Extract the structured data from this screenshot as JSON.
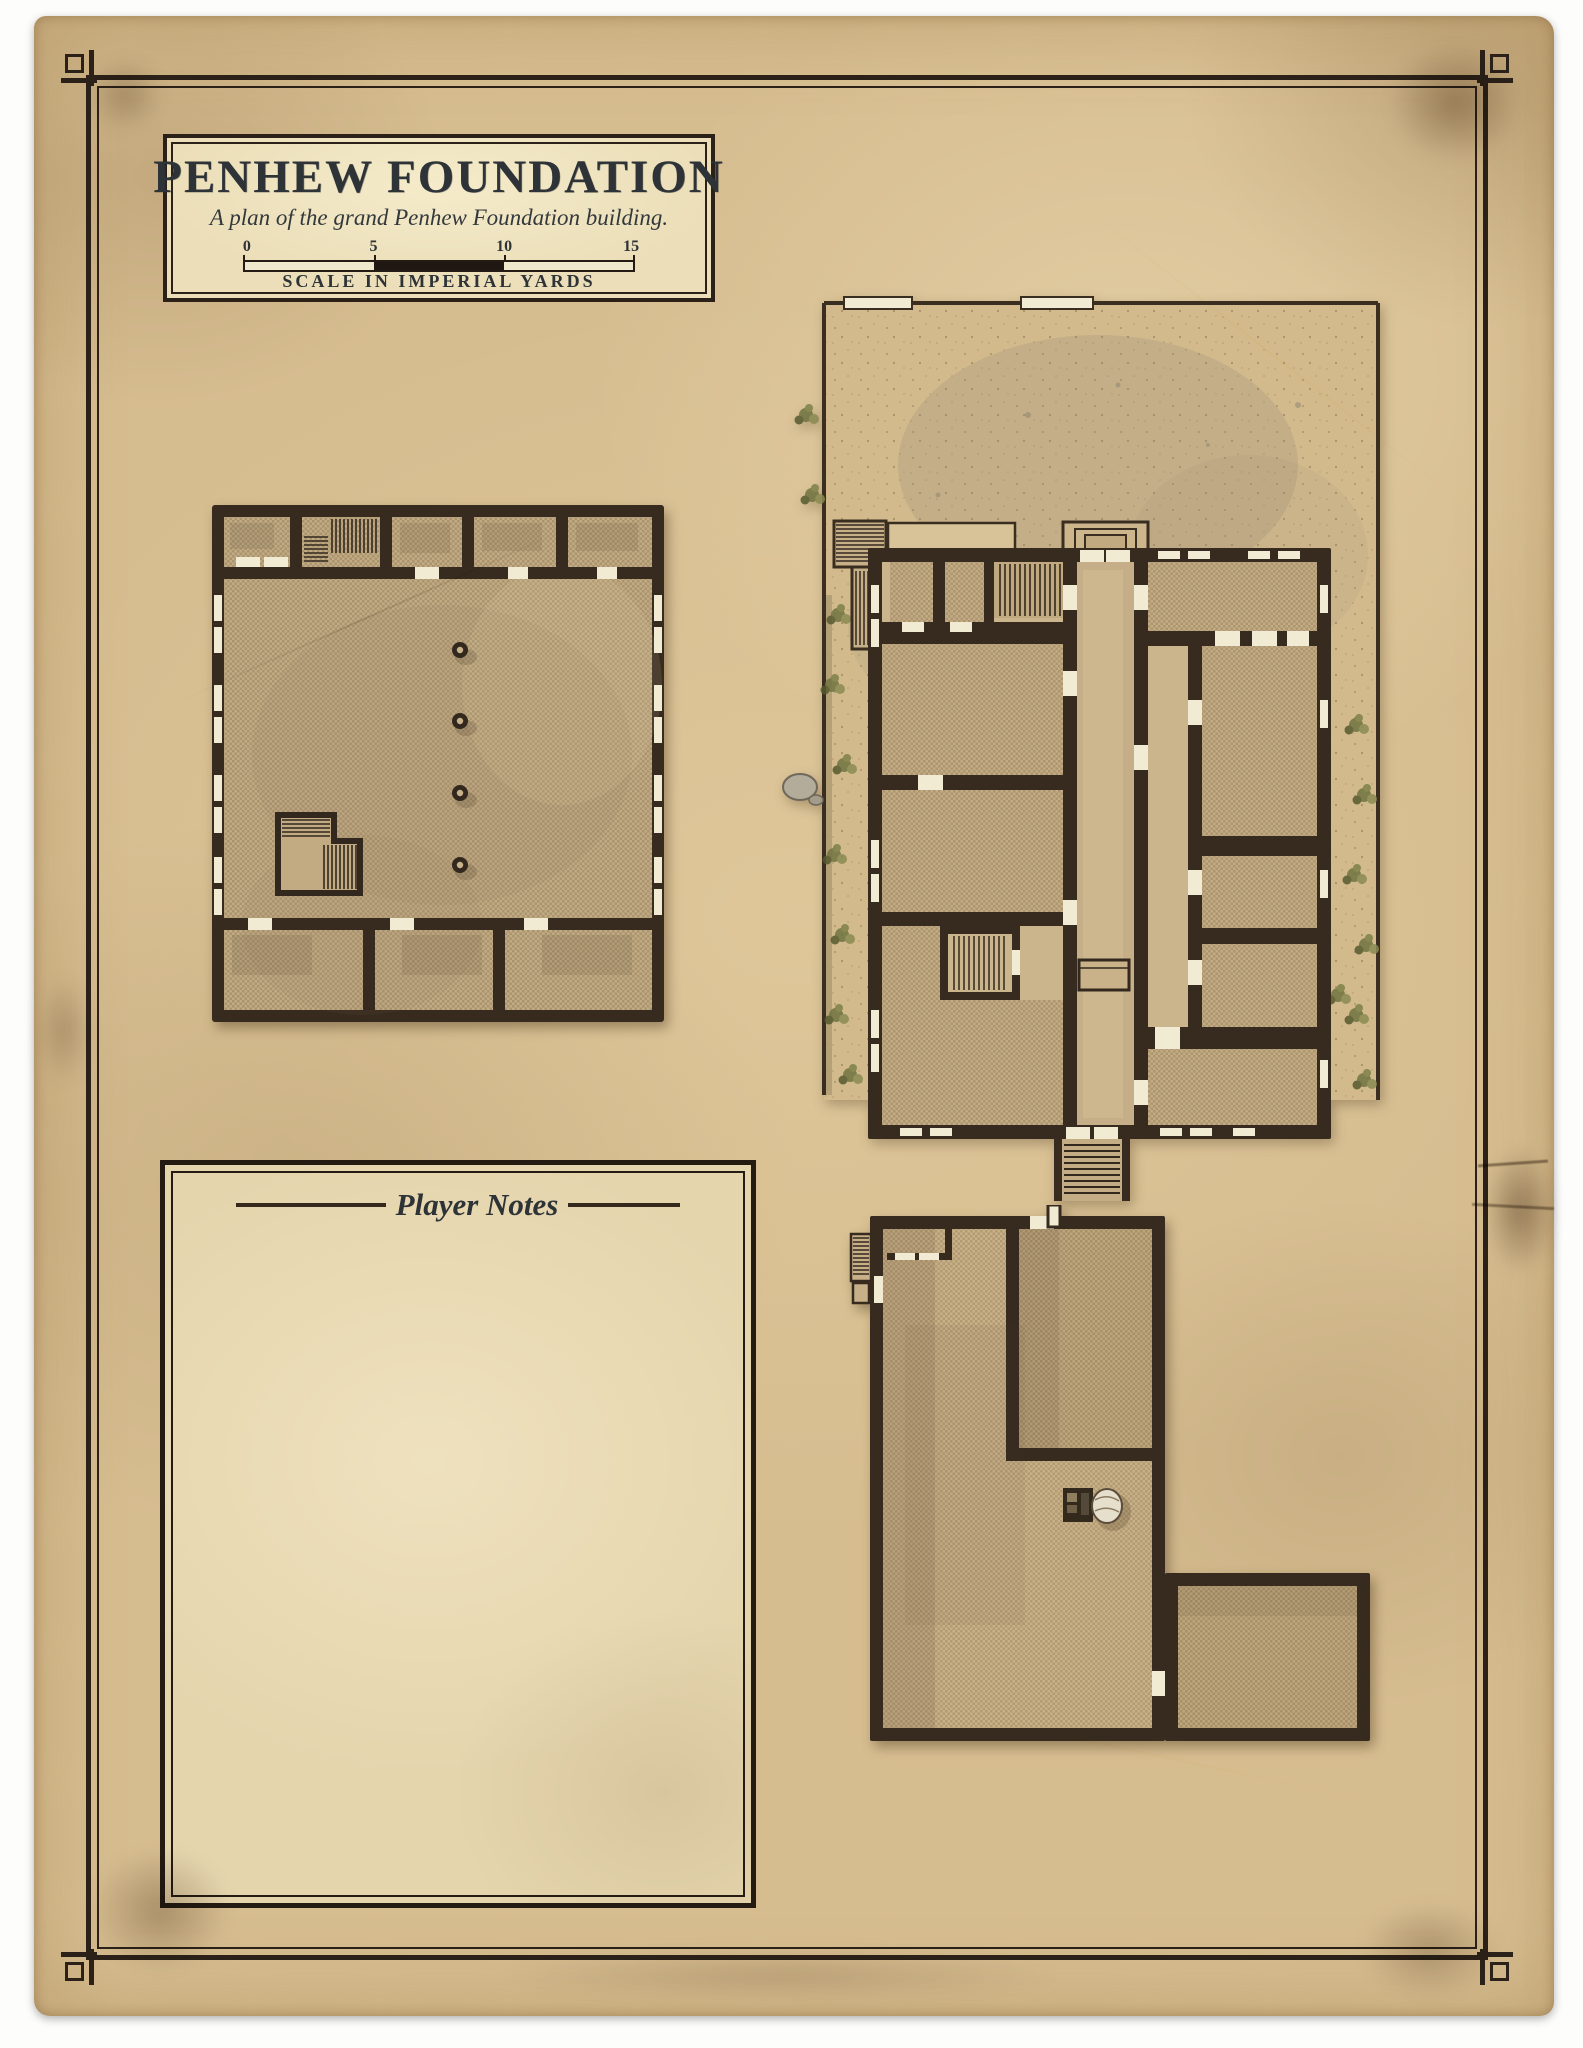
{
  "document": {
    "title": "PENHEW FOUNDATION",
    "subtitle": "A plan of the grand Penhew Foundation building.",
    "scale_bar": {
      "ticks": [
        "0",
        "5",
        "10",
        "15"
      ],
      "caption": "SCALE IN IMPERIAL YARDS"
    },
    "player_notes_title": "Player Notes"
  },
  "colors": {
    "paper": "#d6bd90",
    "cartouche_fill": "#ebdeb8",
    "frame_ink": "#2b2118",
    "title_ink": "#2e3337",
    "wall": "#372b1f",
    "room_floor": "#c2ab83",
    "hall_floor": "#d0ba90",
    "window_white": "#f2ebd3",
    "courtyard_sand": "#d2ba8c",
    "vegetation_green": "#6e7340"
  }
}
